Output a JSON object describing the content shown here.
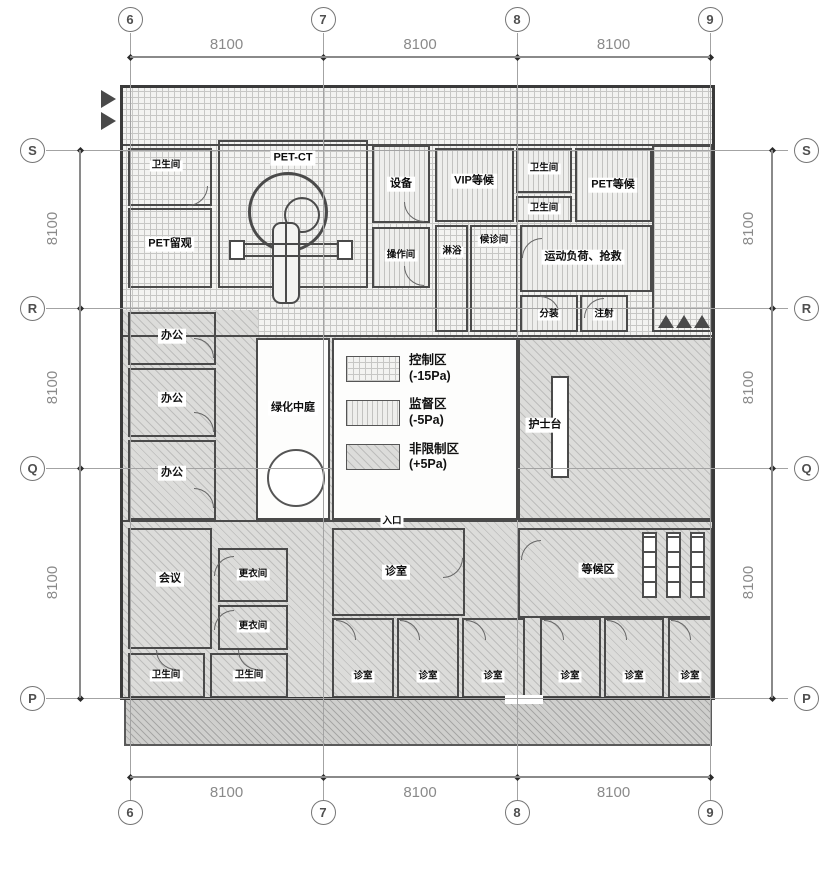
{
  "drawing": {
    "type": "architectural-floor-plan",
    "subject": "PET-CT nuclear medicine department layout",
    "line_color": "#4a4a4a",
    "grid_color": "#a3a3a3"
  },
  "axes": {
    "dim_label": "8100",
    "cols": [
      {
        "id": "6",
        "x": 130
      },
      {
        "id": "7",
        "x": 323
      },
      {
        "id": "8",
        "x": 517
      },
      {
        "id": "9",
        "x": 710
      }
    ],
    "rows": [
      {
        "id": "S",
        "y": 150
      },
      {
        "id": "R",
        "y": 308
      },
      {
        "id": "Q",
        "y": 468
      },
      {
        "id": "P",
        "y": 698
      }
    ],
    "col_dims": [
      "8100",
      "8100",
      "8100"
    ],
    "row_dims": [
      "8100",
      "8100",
      "8100"
    ]
  },
  "legend": {
    "items": [
      {
        "label": "控制区",
        "pressure": "(-15Pa)",
        "pattern": "cross"
      },
      {
        "label": "监督区",
        "pressure": "(-5Pa)",
        "pattern": "vlines"
      },
      {
        "label": "非限制区",
        "pressure": "(+5Pa)",
        "pattern": "diag"
      }
    ]
  },
  "rooms": [
    {
      "name": "toilet-top-left",
      "label": "卫生间",
      "x": 128,
      "y": 148,
      "w": 84,
      "h": 58,
      "fill": "none",
      "lx": 166,
      "ly": 166,
      "small": true
    },
    {
      "name": "pet-ct",
      "label": "PET-CT",
      "x": 218,
      "y": 140,
      "w": 150,
      "h": 148,
      "fill": "none",
      "lx": 293,
      "ly": 158
    },
    {
      "name": "pet-observation",
      "label": "PET留观",
      "x": 128,
      "y": 208,
      "w": 84,
      "h": 80,
      "fill": "none",
      "lx": 170,
      "ly": 244
    },
    {
      "name": "equipment",
      "label": "设备",
      "x": 372,
      "y": 145,
      "w": 58,
      "h": 78,
      "fill": "vlines",
      "lx": 401,
      "ly": 184
    },
    {
      "name": "control-room",
      "label": "操作间",
      "x": 372,
      "y": 227,
      "w": 58,
      "h": 61,
      "fill": "vlines",
      "lx": 401,
      "ly": 256,
      "small": true
    },
    {
      "name": "vip-waiting",
      "label": "VIP等候",
      "x": 435,
      "y": 148,
      "w": 79,
      "h": 74,
      "fill": "vlines",
      "lx": 474,
      "ly": 181
    },
    {
      "name": "toilet-right-1",
      "label": "卫生间",
      "x": 516,
      "y": 148,
      "w": 56,
      "h": 45,
      "fill": "vlines",
      "lx": 544,
      "ly": 169,
      "small": true
    },
    {
      "name": "toilet-right-2",
      "label": "卫生间",
      "x": 516,
      "y": 196,
      "w": 56,
      "h": 26,
      "fill": "vlines",
      "lx": 544,
      "ly": 209,
      "small": true
    },
    {
      "name": "pet-waiting",
      "label": "PET等候",
      "x": 575,
      "y": 148,
      "w": 77,
      "h": 74,
      "fill": "vlines",
      "lx": 613,
      "ly": 185
    },
    {
      "name": "shower",
      "label": "淋浴",
      "x": 435,
      "y": 225,
      "w": 33,
      "h": 107,
      "fill": "none",
      "lx": 452,
      "ly": 252,
      "small": true
    },
    {
      "name": "patient-waiting-room",
      "label": "候诊间",
      "x": 470,
      "y": 225,
      "w": 48,
      "h": 107,
      "fill": "none",
      "lx": 494,
      "ly": 241,
      "small": true
    },
    {
      "name": "stress-rescue",
      "label": "运动负荷、抢救",
      "x": 520,
      "y": 225,
      "w": 132,
      "h": 67,
      "fill": "vlines",
      "lx": 583,
      "ly": 257
    },
    {
      "name": "dispensing",
      "label": "分装",
      "x": 520,
      "y": 295,
      "w": 58,
      "h": 37,
      "fill": "vlines",
      "lx": 549,
      "ly": 315,
      "small": true
    },
    {
      "name": "injection",
      "label": "注射",
      "x": 580,
      "y": 295,
      "w": 48,
      "h": 37,
      "fill": "vlines",
      "lx": 604,
      "ly": 315,
      "small": true
    },
    {
      "name": "corner-area",
      "label": "",
      "x": 652,
      "y": 145,
      "w": 60,
      "h": 187,
      "fill": "none"
    },
    {
      "name": "office-1",
      "label": "办公",
      "x": 128,
      "y": 312,
      "w": 88,
      "h": 53,
      "fill": "none",
      "lx": 172,
      "ly": 336
    },
    {
      "name": "office-2",
      "label": "办公",
      "x": 128,
      "y": 368,
      "w": 88,
      "h": 69,
      "fill": "none",
      "lx": 172,
      "ly": 399
    },
    {
      "name": "office-3",
      "label": "办公",
      "x": 128,
      "y": 440,
      "w": 88,
      "h": 80,
      "fill": "none",
      "lx": 172,
      "ly": 473
    },
    {
      "name": "green-atrium",
      "label": "绿化中庭",
      "x": 256,
      "y": 338,
      "w": 74,
      "h": 182,
      "fill": "white",
      "lx": 293,
      "ly": 408
    },
    {
      "name": "nurse-area",
      "label": "护士台",
      "x": 518,
      "y": 338,
      "w": 194,
      "h": 182,
      "fill": "none",
      "lx": 545,
      "ly": 425
    },
    {
      "name": "meeting",
      "label": "会议",
      "x": 128,
      "y": 528,
      "w": 84,
      "h": 121,
      "fill": "none",
      "lx": 170,
      "ly": 579
    },
    {
      "name": "locker-1",
      "label": "更衣间",
      "x": 218,
      "y": 548,
      "w": 70,
      "h": 54,
      "fill": "none",
      "lx": 253,
      "ly": 575,
      "small": true
    },
    {
      "name": "locker-2",
      "label": "更衣间",
      "x": 218,
      "y": 605,
      "w": 70,
      "h": 45,
      "fill": "none",
      "lx": 253,
      "ly": 627,
      "small": true
    },
    {
      "name": "toilet-bottom-1",
      "label": "卫生间",
      "x": 128,
      "y": 653,
      "w": 77,
      "h": 45,
      "fill": "none",
      "lx": 166,
      "ly": 676,
      "small": true
    },
    {
      "name": "toilet-bottom-2",
      "label": "卫生间",
      "x": 210,
      "y": 653,
      "w": 78,
      "h": 45,
      "fill": "none",
      "lx": 249,
      "ly": 676,
      "small": true
    },
    {
      "name": "consult-large",
      "label": "诊室",
      "x": 332,
      "y": 528,
      "w": 133,
      "h": 88,
      "fill": "none",
      "lx": 396,
      "ly": 572
    },
    {
      "name": "waiting-zone",
      "label": "等候区",
      "x": 518,
      "y": 528,
      "w": 194,
      "h": 90,
      "fill": "none",
      "lx": 598,
      "ly": 570
    },
    {
      "name": "consult-1",
      "label": "诊室",
      "x": 332,
      "y": 618,
      "w": 62,
      "h": 80,
      "fill": "none",
      "lx": 363,
      "ly": 677,
      "small": true
    },
    {
      "name": "consult-2",
      "label": "诊室",
      "x": 397,
      "y": 618,
      "w": 62,
      "h": 80,
      "fill": "none",
      "lx": 428,
      "ly": 677,
      "small": true
    },
    {
      "name": "consult-3",
      "label": "诊室",
      "x": 462,
      "y": 618,
      "w": 63,
      "h": 80,
      "fill": "none",
      "lx": 493,
      "ly": 677,
      "small": true
    },
    {
      "name": "consult-4",
      "label": "诊室",
      "x": 540,
      "y": 618,
      "w": 61,
      "h": 80,
      "fill": "none",
      "lx": 570,
      "ly": 677,
      "small": true
    },
    {
      "name": "consult-5",
      "label": "诊室",
      "x": 604,
      "y": 618,
      "w": 60,
      "h": 80,
      "fill": "none",
      "lx": 634,
      "ly": 677,
      "small": true
    },
    {
      "name": "consult-6",
      "label": "诊室",
      "x": 668,
      "y": 618,
      "w": 44,
      "h": 80,
      "fill": "none",
      "lx": 690,
      "ly": 677,
      "small": true
    }
  ],
  "annotations": [
    {
      "name": "entrance-label",
      "label": "入口",
      "x": 392,
      "y": 522
    }
  ]
}
